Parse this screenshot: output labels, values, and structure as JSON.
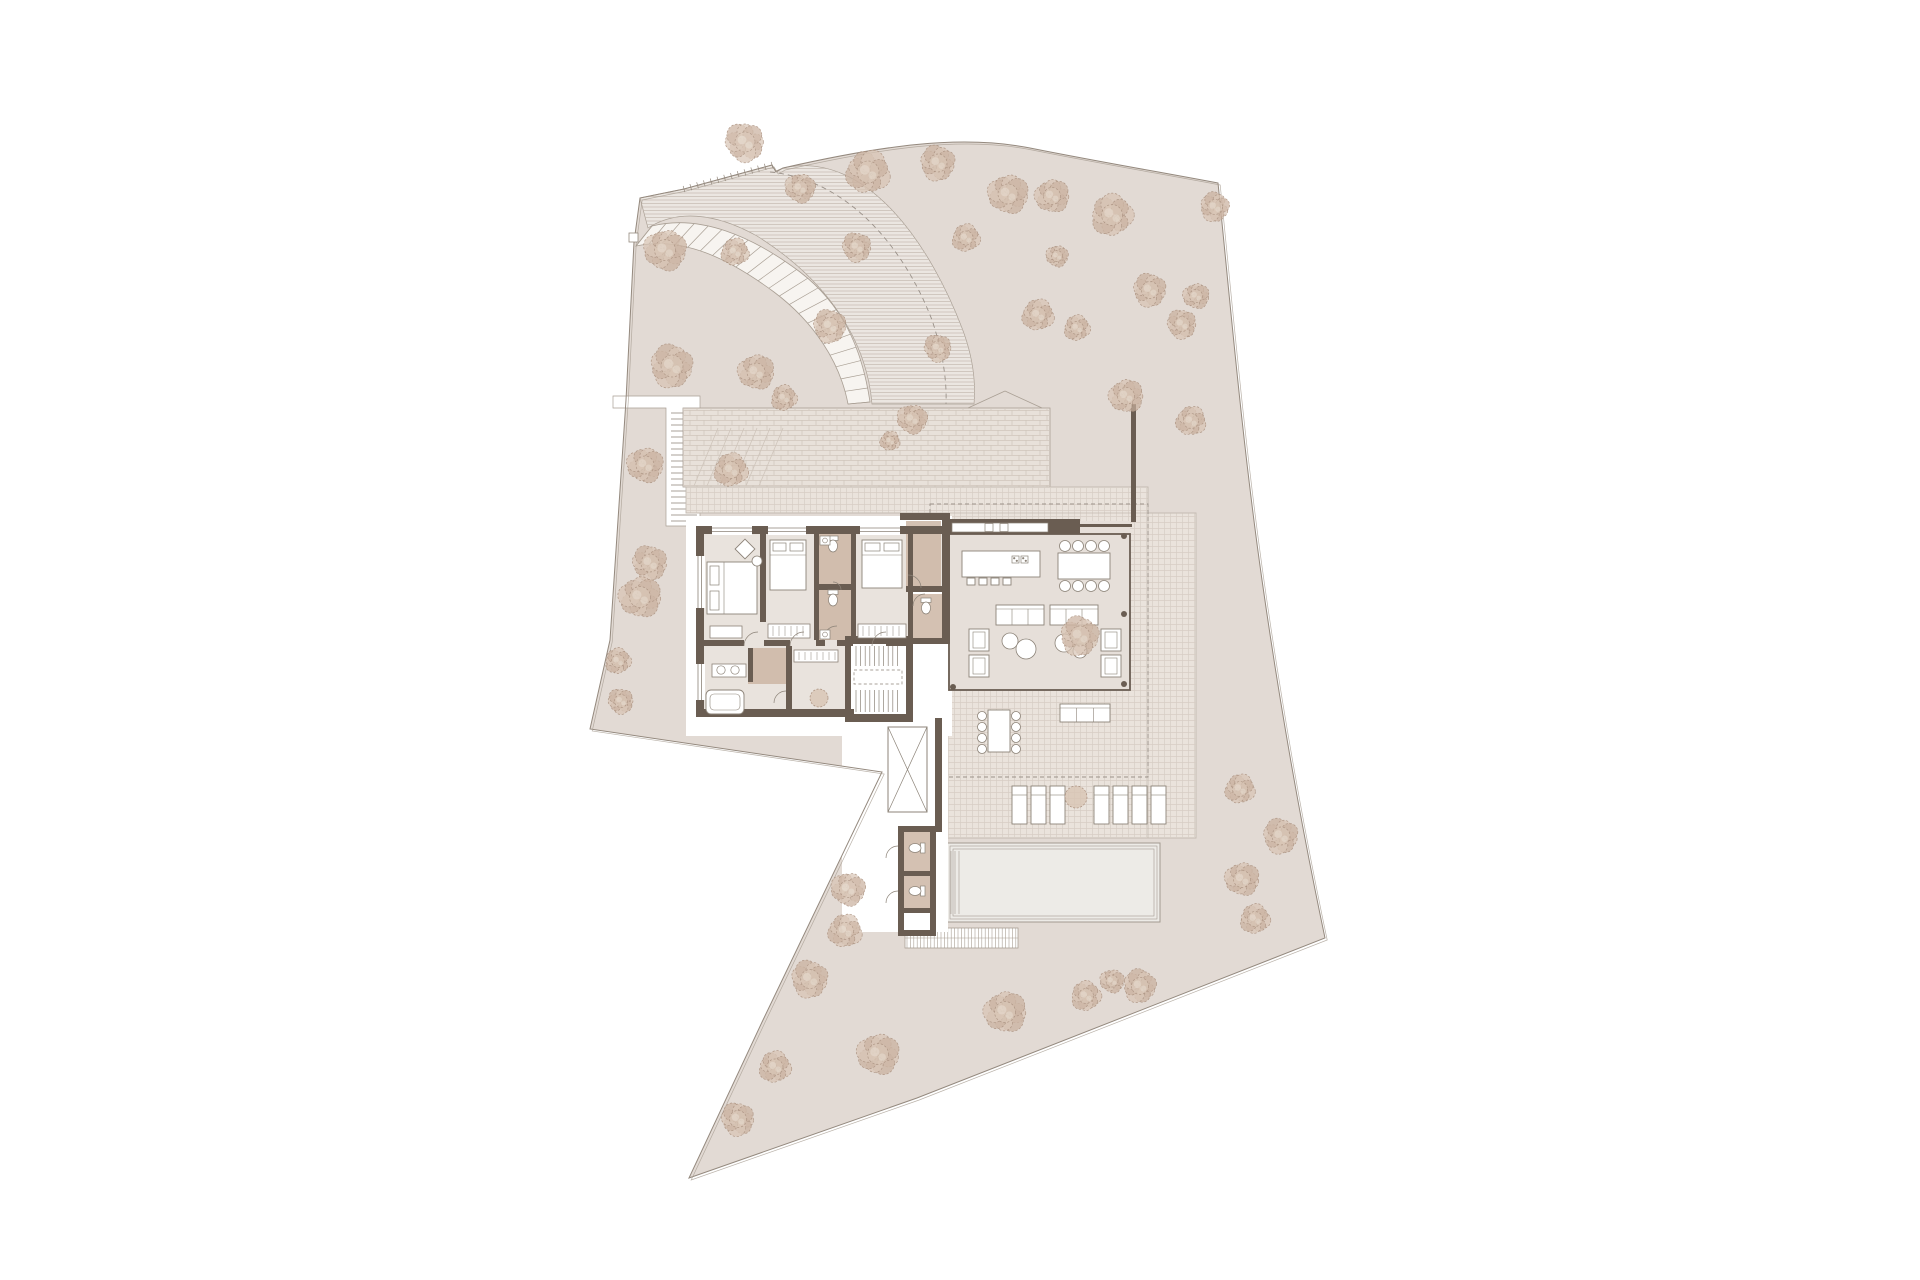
{
  "meta": {
    "type": "architectural-site-plan",
    "text_labels": []
  },
  "colors": {
    "bg": "#ffffff",
    "siteFill": "#e2dad4",
    "boundary": "#94897e",
    "boundary2": "#a99f94",
    "hatchBg": "#ebe6e1",
    "hatchLine": "#c9bfb6",
    "brickBg": "#e8e1da",
    "brickLine": "#cfc5bb",
    "gridBg": "#eae3dc",
    "gridLine": "#d7cdc4",
    "poolFill": "#edebe7",
    "poolLine": "#a39a91",
    "floor": "#e9e3dd",
    "floorPav": "#e6dfd9",
    "wall": "#6a5d52",
    "tan": "#c3a997",
    "tanLight": "#cdb6a4",
    "furn": "#8c8378",
    "white": "#ffffff",
    "treeA": "#c9b09e",
    "treeB": "#d8c4b4",
    "treeHi": "#e8dccf",
    "treeStroke": "#a88e7c",
    "dash": "#9a9189",
    "seam": "#c4bbb2"
  },
  "site": {
    "outline": "M640,198 L684,189 L772,165 L776,172 L783,168 C880,146 960,134 1030,148 C1100,162 1160,172 1218,183 C1230,300 1242,440 1262,580 C1282,720 1306,848 1325,938 L917,1098 L689,1178 L763,1020 L882,772 L590,729 L610,640 L626,400 L634,242 Z",
    "offset": [
      2.2,
      2.0
    ],
    "marker": [
      629,
      233,
      9,
      9
    ],
    "entranceTicks": {
      "x1": 684,
      "y1": 189,
      "x2": 772,
      "y2": 165,
      "n": 13,
      "len": 3.2
    }
  },
  "drive": {
    "region": "M640,198 L684,189 L772,165 L776,171 L783,168 C870,149 933,252 962,328 C972,354 976,380 974,404 L872,404 C866,332 818,274 757,236 C714,212 676,210 648,228 Z",
    "center": "M770,172 C850,180 905,250 932,320 C942,350 947,378 946,404",
    "fan": "M968,408 L1005,391 M1042,408 L1005,391"
  },
  "curvedStair": {
    "c1": "M652,226 C700,214 752,236 800,272 C842,304 862,348 870,402",
    "c2": "M636,246 C682,236 728,258 774,292 C814,322 840,362 848,404",
    "band": "M652,226 C700,214 752,236 800,272 C842,304 862,348 870,402 L848,404 C840,362 814,322 774,292 C728,258 682,236 636,246 Z",
    "rungs": 22
  },
  "leftPath": {
    "poly": "M613,396 L700,396 L700,526 L666,526 L666,408 L613,408 Z",
    "stair": {
      "x1": 671,
      "x2": 697,
      "y1": 413,
      "y2": 521,
      "step": 6
    }
  },
  "court": {
    "rect": [
      683,
      408,
      367,
      79
    ],
    "ramp": [
      [
        694,
        486,
        718,
        428
      ],
      [
        707,
        486,
        731,
        428
      ],
      [
        720,
        486,
        744,
        428
      ],
      [
        733,
        486,
        757,
        428
      ],
      [
        746,
        486,
        770,
        428
      ],
      [
        759,
        486,
        783,
        428
      ]
    ],
    "steps": [
      688,
      692,
      696,
      700,
      704
    ]
  },
  "terrace": {
    "poly": "M686,487 L1148,487 L1148,513 L1196,513 L1196,838 L947,838 L947,513 L686,513 Z",
    "seams": [
      "M1148,487 L1148,838",
      "M686,513 L1196,513"
    ]
  },
  "overhang": [
    930,
    504,
    218,
    273
  ],
  "pool": {
    "rect": [
      947,
      843,
      213,
      79
    ],
    "insets": [
      3,
      6
    ],
    "steps": [
      951,
      955,
      959
    ]
  },
  "gardenStair": {
    "x1": 905,
    "x2": 1018,
    "y1": 928,
    "y2": 948,
    "step": 3.4
  },
  "pads": [
    [
      686,
      516,
      266,
      220
    ],
    [
      842,
      700,
      106,
      232
    ]
  ],
  "elevator": [
    888,
    727,
    39,
    85
  ],
  "house": {
    "floors": [
      [
        700,
        530,
        248,
        62,
        "floor"
      ],
      [
        700,
        592,
        213,
        56,
        "floor"
      ],
      [
        700,
        648,
        152,
        67,
        "floor"
      ],
      [
        948,
        521,
        182,
        170,
        "floorPav"
      ],
      [
        851,
        644,
        55,
        70,
        "white"
      ]
    ],
    "tans": [
      [
        819,
        534,
        32,
        50
      ],
      [
        819,
        590,
        32,
        50
      ],
      [
        906,
        521,
        35,
        65
      ],
      [
        908,
        594,
        34,
        44
      ],
      [
        748,
        648,
        38,
        36
      ],
      [
        903,
        832,
        27,
        39
      ],
      [
        903,
        876,
        27,
        32
      ]
    ],
    "walls": [
      [
        696,
        526,
        258,
        8
      ],
      [
        696,
        526,
        8,
        191
      ],
      [
        696,
        709,
        158,
        8
      ],
      [
        760,
        534,
        6,
        88
      ],
      [
        814,
        534,
        5,
        106
      ],
      [
        851,
        534,
        5,
        106
      ],
      [
        819,
        584,
        32,
        6
      ],
      [
        908,
        534,
        5,
        106
      ],
      [
        900,
        513,
        50,
        7
      ],
      [
        942,
        513,
        8,
        131
      ],
      [
        906,
        586,
        44,
        6
      ],
      [
        906,
        638,
        42,
        6
      ],
      [
        945,
        519,
        135,
        15
      ],
      [
        1078,
        524,
        54,
        3
      ],
      [
        704,
        640,
        40,
        6
      ],
      [
        764,
        640,
        26,
        6
      ],
      [
        816,
        640,
        9,
        6
      ],
      [
        837,
        640,
        16,
        6
      ],
      [
        886,
        640,
        24,
        6
      ],
      [
        786,
        646,
        6,
        71
      ],
      [
        748,
        648,
        5,
        34
      ],
      [
        845,
        636,
        67,
        8
      ],
      [
        845,
        636,
        6,
        86
      ],
      [
        906,
        636,
        7,
        86
      ],
      [
        845,
        714,
        67,
        8
      ],
      [
        935,
        718,
        7,
        114
      ],
      [
        898,
        826,
        6,
        110
      ],
      [
        930,
        826,
        6,
        110
      ],
      [
        898,
        826,
        38,
        6
      ],
      [
        898,
        930,
        38,
        6
      ],
      [
        898,
        871,
        38,
        5
      ],
      [
        898,
        908,
        38,
        5
      ],
      [
        1131,
        404,
        5,
        118
      ]
    ],
    "pavilion": [
      949,
      534,
      181,
      156
    ],
    "counter": {
      "rect": [
        952,
        523,
        96,
        9
      ],
      "appl": [
        [
          985,
          523.5,
          8,
          8
        ],
        [
          1000,
          523.5,
          8,
          8
        ]
      ]
    },
    "windows": [
      [
        712,
        525,
        40,
        10,
        "h"
      ],
      [
        768,
        525,
        38,
        10,
        "h"
      ],
      [
        860,
        525,
        40,
        10,
        "h"
      ],
      [
        695,
        556,
        10,
        52,
        "v"
      ],
      [
        695,
        664,
        10,
        36,
        "v"
      ]
    ],
    "wardrobes": [
      [
        768,
        624,
        42,
        14
      ],
      [
        858,
        624,
        48,
        14
      ],
      [
        794,
        650,
        44,
        12
      ]
    ],
    "shelf": [
      710,
      626,
      32,
      12
    ],
    "columns": [
      [
        1124,
        536
      ],
      [
        1124,
        614
      ],
      [
        1124,
        684
      ],
      [
        953,
        687
      ]
    ],
    "arcs": [
      "M744,646 A14,14 0 0 1 758,632",
      "M790,646 A14,14 0 0 1 804,632",
      "M823,640 A14,14 0 0 1 837,626",
      "M872,646 A14,14 0 0 1 886,632",
      "M921,588 A13,13 0 0 0 908,575",
      "M833,582 A8,8 0 0 1 841,590",
      "M774,703 A12,12 0 0 1 786,691",
      "M898,846 A12,12 0 0 0 886,858",
      "M898,891 A12,12 0 0 0 886,903",
      "M913,606 A12,12 0 0 1 925,594"
    ],
    "stairBlock": {
      "top": {
        "x1": 856,
        "x2": 902,
        "y": 646,
        "h": 20,
        "step": 4.6
      },
      "dash": [
        854,
        670,
        48,
        14
      ],
      "bot": {
        "x1": 856,
        "x2": 902,
        "y": 690,
        "h": 22,
        "step": 4.6
      }
    }
  },
  "furniture": {
    "beds": [
      [
        707,
        562,
        50,
        52,
        "h"
      ],
      [
        770,
        540,
        36,
        50,
        "v"
      ],
      [
        862,
        540,
        40,
        48,
        "v"
      ]
    ],
    "deskDiag": {
      "cx": 745,
      "cy": 549,
      "s": 14
    },
    "deskChair": [
      757,
      561,
      5
    ],
    "island": {
      "rect": [
        962,
        551,
        78,
        26
      ],
      "cook": [
        [
          1012,
          556,
          7,
          7
        ],
        [
          1021,
          556,
          7,
          7
        ]
      ],
      "stools": [
        [
          967,
          578,
          8,
          7
        ],
        [
          979,
          578,
          8,
          7
        ],
        [
          991,
          578,
          8,
          7
        ],
        [
          1003,
          578,
          8,
          7
        ]
      ]
    },
    "dining": {
      "table": [
        1058,
        553,
        52,
        26
      ],
      "chairXs": [
        1065,
        1078,
        1091,
        1104
      ],
      "rowYs": [
        546,
        586
      ],
      "r": 5.5
    },
    "sofas": [
      [
        996,
        605,
        48,
        20
      ],
      [
        1050,
        605,
        48,
        20
      ],
      [
        1060,
        704,
        50,
        18
      ]
    ],
    "armchairs": [
      [
        969,
        629,
        20,
        22
      ],
      [
        969,
        655,
        20,
        22
      ],
      [
        1101,
        629,
        20,
        22
      ],
      [
        1101,
        655,
        20,
        22
      ]
    ],
    "roundTables": [
      [
        1010,
        641,
        8
      ],
      [
        1026,
        649,
        10
      ],
      [
        1064,
        643,
        9
      ],
      [
        1080,
        651,
        7
      ]
    ],
    "outTable": [
      988,
      710,
      22,
      42
    ],
    "outChairs": {
      "xs": [
        982,
        1016
      ],
      "ys": [
        716,
        727,
        738,
        749
      ],
      "r": 4.5
    },
    "loungers": {
      "xs": [
        1012,
        1031,
        1050,
        1094,
        1113,
        1132,
        1151
      ],
      "y": 786,
      "w": 15,
      "h": 38
    },
    "loungePlant": [
      1076,
      797,
      11
    ],
    "wcs": [
      [
        833,
        546,
        0
      ],
      [
        833,
        600,
        0
      ],
      [
        926,
        608,
        0
      ],
      [
        915,
        848,
        90
      ],
      [
        915,
        891,
        90
      ]
    ],
    "sinkCounter": [
      712,
      664,
      34,
      13
    ],
    "sinkCircles": [
      [
        721,
        670
      ],
      [
        735,
        670
      ]
    ],
    "smallSinks": [
      [
        820,
        536,
        10,
        9
      ],
      [
        820,
        630,
        10,
        9
      ]
    ],
    "tub": [
      706,
      690,
      38,
      24
    ],
    "plant": [
      819,
      698,
      9
    ]
  },
  "trees": [
    [
      745,
      142,
      1.0
    ],
    [
      800,
      188,
      0.75
    ],
    [
      868,
      172,
      1.1
    ],
    [
      938,
      163,
      0.9
    ],
    [
      1008,
      194,
      1.0
    ],
    [
      966,
      238,
      0.7
    ],
    [
      857,
      247,
      0.75
    ],
    [
      1052,
      196,
      0.85
    ],
    [
      1112,
      215,
      1.05
    ],
    [
      1215,
      207,
      0.75
    ],
    [
      1057,
      256,
      0.55
    ],
    [
      1038,
      315,
      0.8
    ],
    [
      1150,
      290,
      0.85
    ],
    [
      1196,
      296,
      0.65
    ],
    [
      1077,
      328,
      0.65
    ],
    [
      1182,
      324,
      0.75
    ],
    [
      1126,
      396,
      0.85
    ],
    [
      1191,
      421,
      0.75
    ],
    [
      1080,
      636,
      1.0
    ],
    [
      665,
      250,
      1.05
    ],
    [
      735,
      252,
      0.7
    ],
    [
      830,
      326,
      0.85
    ],
    [
      756,
      372,
      0.9
    ],
    [
      784,
      398,
      0.65
    ],
    [
      938,
      348,
      0.7
    ],
    [
      912,
      419,
      0.75
    ],
    [
      890,
      441,
      0.5
    ],
    [
      672,
      366,
      1.1
    ],
    [
      645,
      465,
      0.9
    ],
    [
      731,
      470,
      0.85
    ],
    [
      650,
      563,
      0.9
    ],
    [
      640,
      597,
      1.05
    ],
    [
      618,
      661,
      0.65
    ],
    [
      621,
      701,
      0.65
    ],
    [
      848,
      889,
      0.85
    ],
    [
      845,
      931,
      0.85
    ],
    [
      810,
      979,
      0.95
    ],
    [
      878,
      1054,
      1.05
    ],
    [
      775,
      1067,
      0.8
    ],
    [
      738,
      1119,
      0.85
    ],
    [
      1005,
      1012,
      1.05
    ],
    [
      1086,
      996,
      0.75
    ],
    [
      1140,
      986,
      0.85
    ],
    [
      1112,
      981,
      0.6
    ],
    [
      1240,
      789,
      0.75
    ],
    [
      1281,
      836,
      0.9
    ],
    [
      1242,
      879,
      0.85
    ],
    [
      1255,
      919,
      0.75
    ]
  ]
}
